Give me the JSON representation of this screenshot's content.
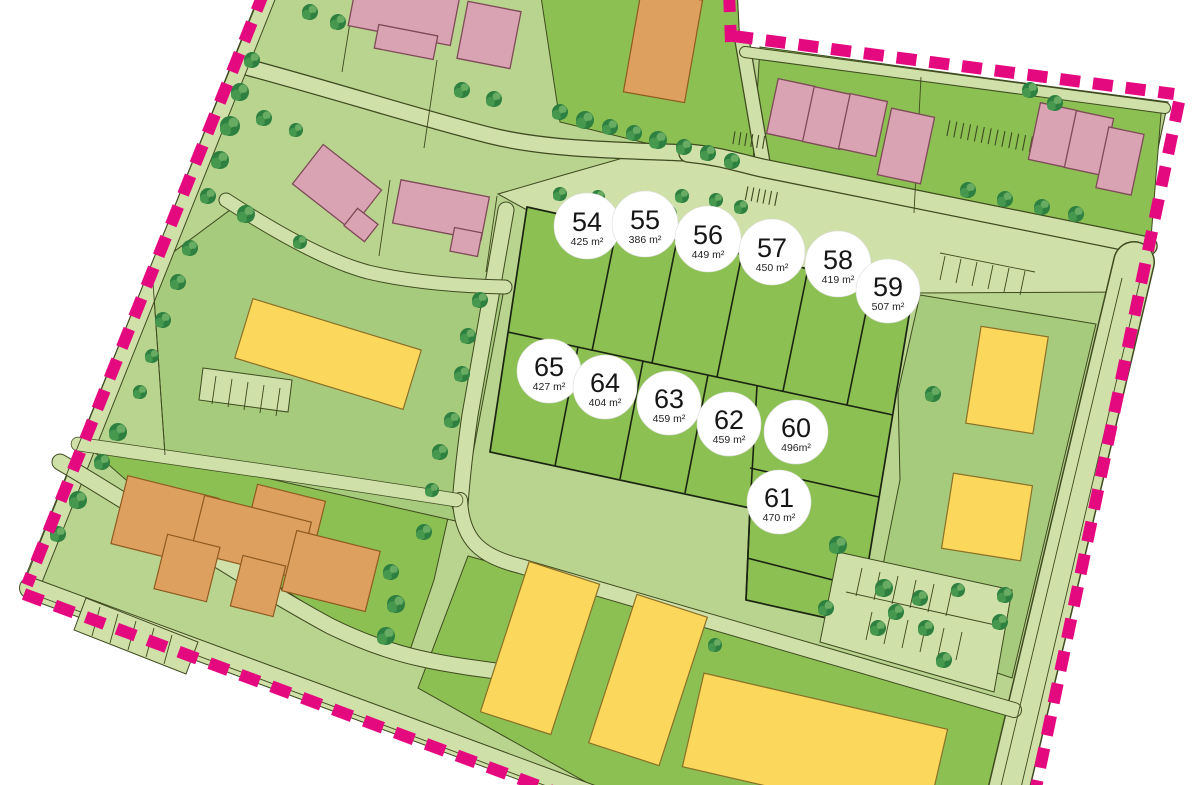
{
  "map": {
    "kind": "residential development site plan",
    "area_unit": "m²"
  },
  "lots": [
    {
      "number": "54",
      "area": "425 m²"
    },
    {
      "number": "55",
      "area": "386 m²"
    },
    {
      "number": "56",
      "area": "449 m²"
    },
    {
      "number": "57",
      "area": "450 m²"
    },
    {
      "number": "58",
      "area": "419 m²"
    },
    {
      "number": "59",
      "area": "507 m²"
    },
    {
      "number": "65",
      "area": "427 m²"
    },
    {
      "number": "64",
      "area": "404 m²"
    },
    {
      "number": "63",
      "area": "459 m²"
    },
    {
      "number": "62",
      "area": "459 m²"
    },
    {
      "number": "60",
      "area": "496m²"
    },
    {
      "number": "61",
      "area": "470 m²"
    }
  ],
  "colors": {
    "boundary": "#e5097f",
    "base_green": "#b9d48f",
    "road_green": "#cfe0a9",
    "block_green": "#a7cb7c",
    "lot_green": "#8cc053",
    "line_dark": "#3f4a20",
    "building_pink": "#daa3b3",
    "building_yellow": "#fbd75b",
    "building_orange": "#dda05f",
    "tree_dark": "#2e8040",
    "tree_mid": "#46984f",
    "tree_light": "#68ab62"
  }
}
